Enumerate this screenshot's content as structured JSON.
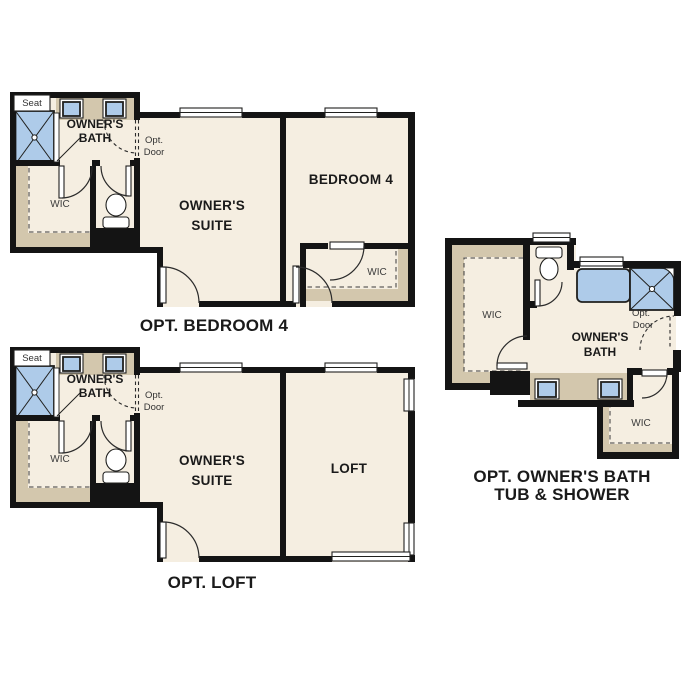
{
  "colors": {
    "wall": "#141414",
    "floor": "#f5eee1",
    "cabinet": "#d3c7ad",
    "fixture": "#aecbe9",
    "background": "#ffffff",
    "text": "#1a1a1a"
  },
  "plans": {
    "bedroom4": {
      "title": "OPT. BEDROOM 4",
      "labels": {
        "seat": "Seat",
        "owners_bath_line1": "OWNER'S",
        "owners_bath_line2": "BATH",
        "opt_door_line1": "Opt.",
        "opt_door_line2": "Door",
        "wic": "WIC",
        "owners_suite_line1": "OWNER'S",
        "owners_suite_line2": "SUITE",
        "bedroom": "BEDROOM 4",
        "wic2": "WIC"
      }
    },
    "loft": {
      "title": "OPT. LOFT",
      "labels": {
        "seat": "Seat",
        "owners_bath_line1": "OWNER'S",
        "owners_bath_line2": "BATH",
        "opt_door_line1": "Opt.",
        "opt_door_line2": "Door",
        "wic": "WIC",
        "owners_suite_line1": "OWNER'S",
        "owners_suite_line2": "SUITE",
        "loft": "LOFT"
      }
    },
    "owners_bath": {
      "title_line1": "OPT. OWNER'S BATH",
      "title_line2": "TUB & SHOWER",
      "labels": {
        "wic": "WIC",
        "owners_bath_line1": "OWNER'S",
        "owners_bath_line2": "BATH",
        "opt_door_line1": "Opt.",
        "opt_door_line2": "Door",
        "wic2": "WIC"
      }
    }
  }
}
